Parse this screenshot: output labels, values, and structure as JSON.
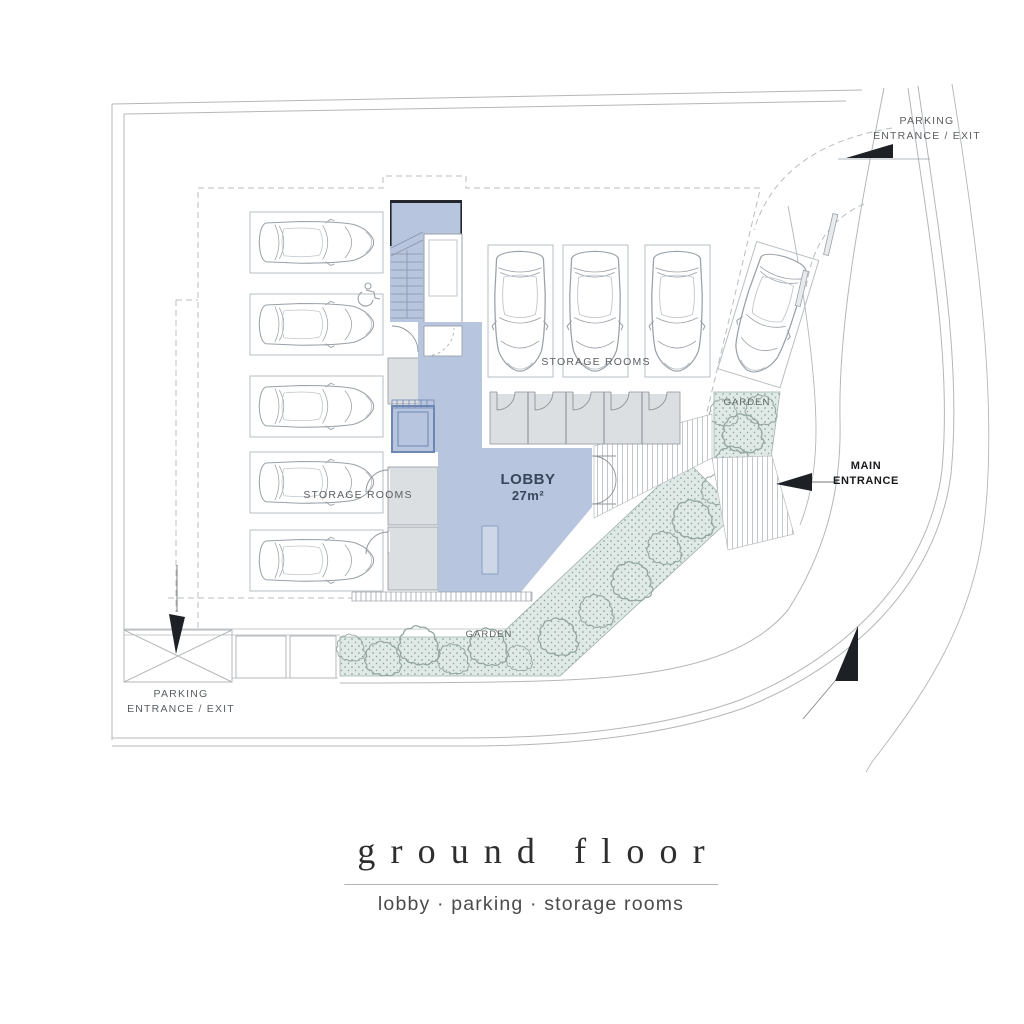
{
  "plan": {
    "parking_entrance_top": {
      "line1": "PARKING",
      "line2": "ENTRANCE / EXIT"
    },
    "parking_entrance_bottom": {
      "line1": "PARKING",
      "line2": "ENTRANCE / EXIT"
    },
    "main_entrance": {
      "line1": "MAIN",
      "line2": "ENTRANCE"
    },
    "storage_rooms_left": "STORAGE ROOMS",
    "storage_rooms_right": "STORAGE ROOMS",
    "garden_bottom": "GARDEN",
    "garden_right": "GARDEN",
    "lobby": {
      "name": "LOBBY",
      "area": "27m²"
    }
  },
  "title_block": {
    "title": "ground floor",
    "subtitle": "lobby · parking · storage rooms"
  },
  "colors": {
    "lobby_fill": "#b7c5de",
    "storage_fill": "#dcdfe2",
    "garden_fill": "#dfe9e5",
    "line": "#9aa1a8",
    "ink": "#1d2126"
  }
}
